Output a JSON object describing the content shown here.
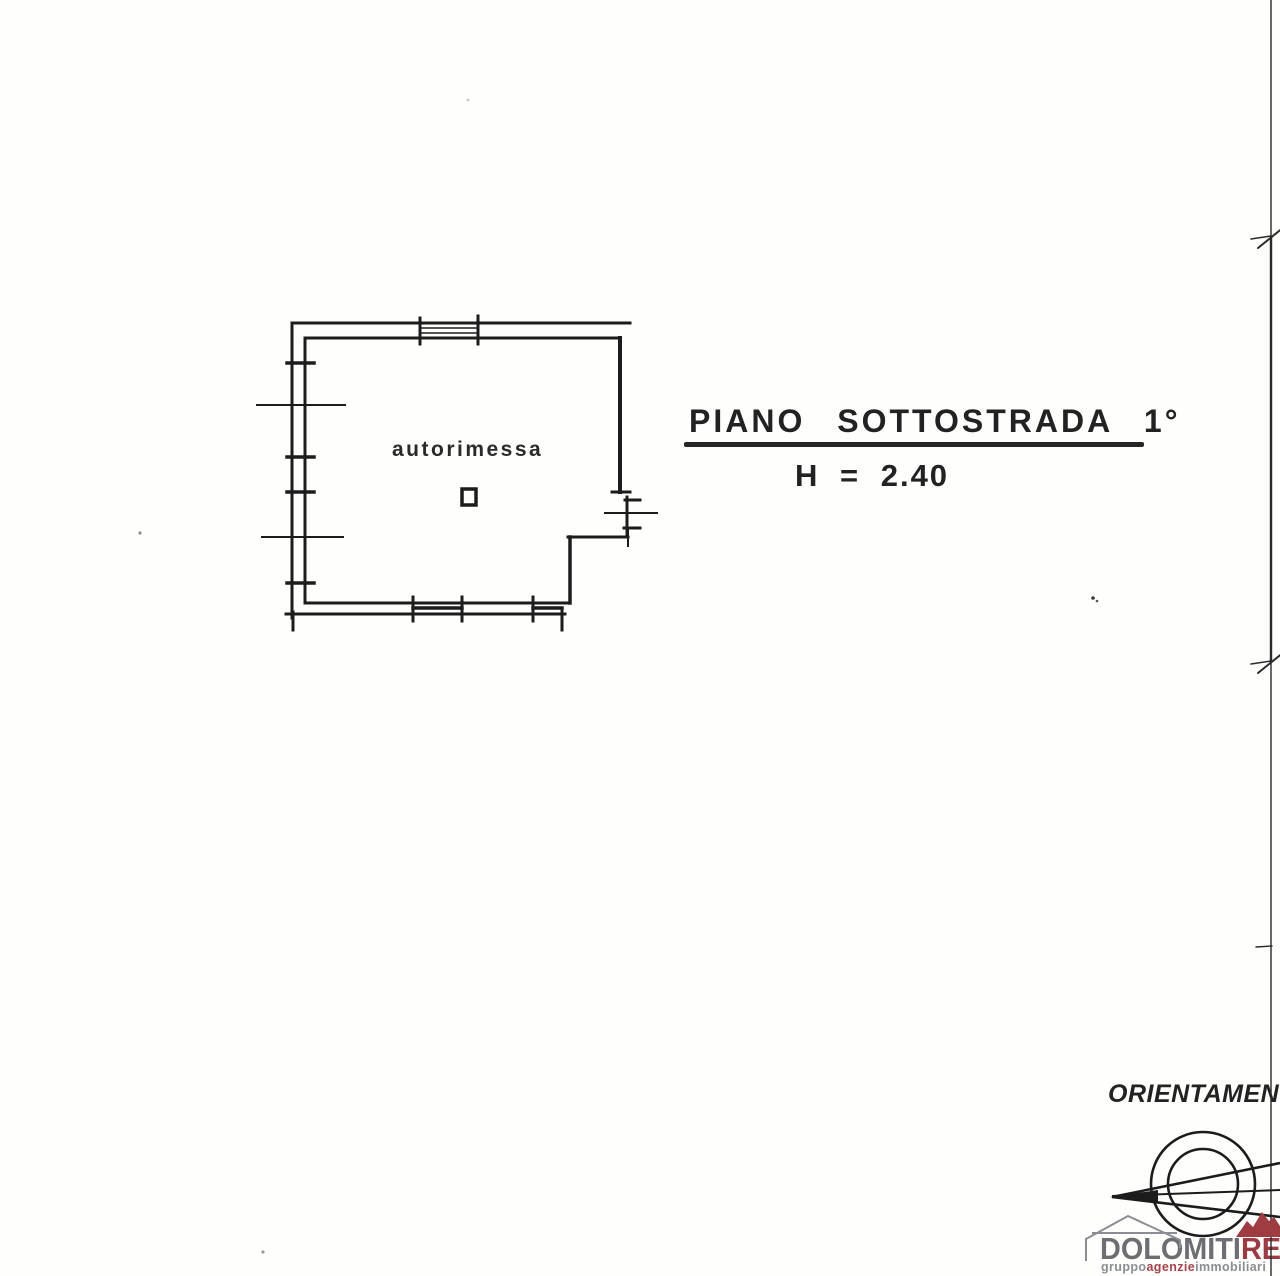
{
  "document_type": "scanned floor plan",
  "title": {
    "text": "PIANO SOTTOSTRADA 1°",
    "height_label": "H = 2.40"
  },
  "plan": {
    "room_label": "autorimessa"
  },
  "orientation": {
    "label": "ORIENTAMENTO"
  },
  "logo": {
    "brand_gray": "DOLOMITI",
    "brand_red": "RE",
    "tagline_gray1": "gruppo",
    "tagline_red": "agenzie",
    "tagline_gray2": "immobiliari"
  },
  "colors": {
    "ink": "#1c1c1c",
    "logo_gray": "#6d6e73",
    "logo_red": "#9c3b44",
    "mountain_red": "#9e3c42",
    "tagline_red": "#a4434c"
  }
}
